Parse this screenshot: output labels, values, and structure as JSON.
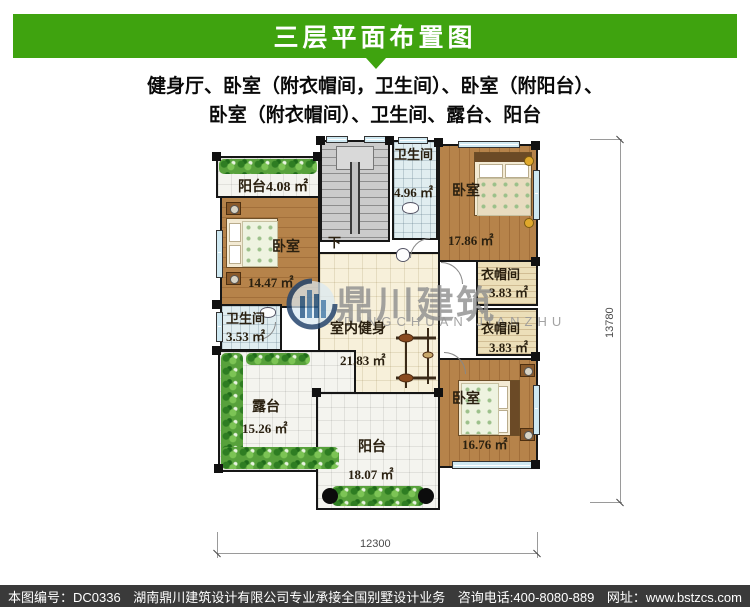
{
  "header": {
    "title": "三层平面布置图",
    "description_line1": "健身厅、卧室（附衣帽间，卫生间）、卧室（附阳台）、",
    "description_line2": "卧室（附衣帽间）、卫生间、露台、阳台"
  },
  "plan": {
    "rooms": {
      "balcony_top": {
        "name": "阳台",
        "area": "4.08 ㎡"
      },
      "bedroom_left": {
        "name": "卧室",
        "area": "14.47 ㎡"
      },
      "bath_top": {
        "name": "卫生间",
        "area": "4.96 ㎡"
      },
      "bedroom_top_right": {
        "name": "卧室",
        "area": "17.86 ㎡"
      },
      "closet_upper": {
        "name": "衣帽间",
        "area": "3.83 ㎡"
      },
      "closet_lower": {
        "name": "衣帽间",
        "area": "3.83 ㎡"
      },
      "bath_left": {
        "name": "卫生间",
        "area": "3.53 ㎡"
      },
      "gym": {
        "name": "室内健身",
        "area": "21.83 ㎡"
      },
      "terrace": {
        "name": "露台",
        "area": "15.26 ㎡"
      },
      "bedroom_bottom_right": {
        "name": "卧室",
        "area": "16.76 ㎡"
      },
      "balcony_bottom": {
        "name": "阳台",
        "area": "18.07 ㎡"
      }
    },
    "stairs_label": "下",
    "dimensions": {
      "bottom": "12300",
      "right": "13780"
    },
    "watermark": {
      "cn": "鼎川建筑",
      "en": "DINGCHUAN JIANZHU"
    }
  },
  "footer": {
    "drawing_number": "本图编号：DC0336",
    "company": "湖南鼎川建筑设计有限公司专业承接全国别墅设计业务",
    "phone": "咨询电话:400-8080-889",
    "website": "网址：www.bstzcs.com"
  },
  "colors": {
    "header_green": "#3fa30f",
    "footer_bg": "#3a3a3a",
    "wood": "#b6834a",
    "gym_tile": "#f7f0da",
    "bath_tile": "#e0edf0",
    "outdoor_tile": "#f4f4ef"
  }
}
